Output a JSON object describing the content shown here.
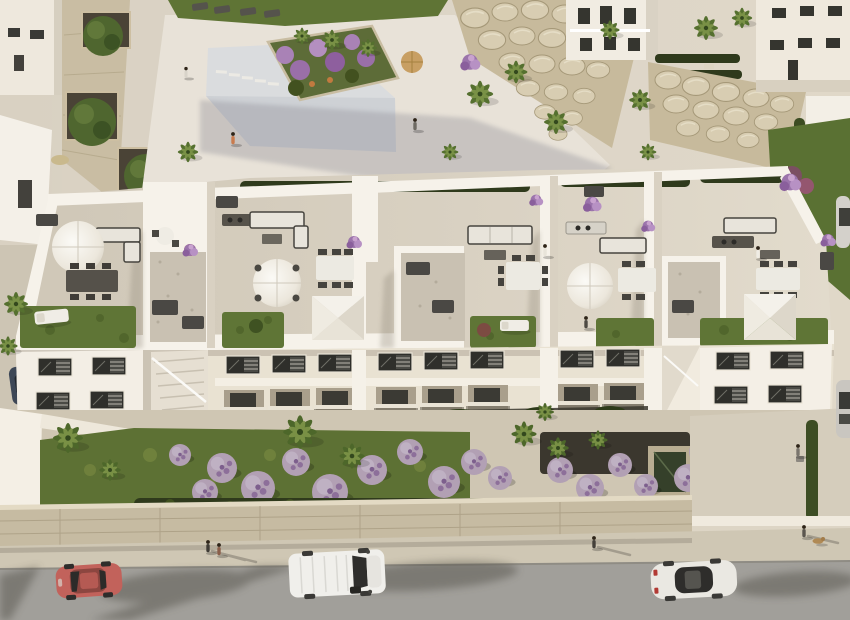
{
  "meta": {
    "type": "aerial-architectural-render",
    "description": "Bird's-eye 3D rendering of a white modern apartment block with private rooftop terraces (parasols, shade canopies, outdoor sofas, dining sets, green-roof lawns), a communal pool deck with rock garden and palm trees behind it, lush lavender-bush front gardens, and a street with parked cars in front.",
    "width": 850,
    "height": 620
  },
  "palette": {
    "paving": "#d9d1c2",
    "deck": "#e8e2d8",
    "pool": "#dadcde",
    "poolShade": "#c5c8ce",
    "lawn": "#5d7134",
    "lawnTop": "#5f7435",
    "grassRoof": "#5f7536",
    "rock": "#c7ba9c",
    "white": "#f6f2ea",
    "whiteBright": "#f4efe5",
    "roofFloor": "#d8d0c1",
    "gravel": "#c9c1b2",
    "facade": "#e9e2d2",
    "mulch": "#3b372e",
    "hedge": "#2f3a1c",
    "bush": "#b2a0b4",
    "palm": "#55702f",
    "road": "#a19f9a",
    "sidewalk": "#cfc7b4",
    "stoneWall": "#c6bba2",
    "driveway": "#d5cdbc",
    "carRed": "#c2625b",
    "vanWhite": "#f0efeb",
    "sedanWhite": "#eae8e2",
    "carBlue": "#3d4756",
    "shadow": "#3f3c36",
    "purple": "#9b74ab",
    "window": "#2f2f2b",
    "cushion": "#e8e4db",
    "furnitureDark": "#47453f"
  },
  "inventory": {
    "vehicles": [
      {
        "kind": "red hatchback",
        "color": "#c2625b"
      },
      {
        "kind": "white delivery van",
        "color": "#f0efeb"
      },
      {
        "kind": "white sedan",
        "color": "#eae8e2"
      },
      {
        "kind": "dark car parked left lane",
        "color": "#3d4756"
      },
      {
        "kind": "gray car right edge (partial)",
        "color": "#c9c6c0"
      }
    ],
    "rooftop_amenities": [
      "round parasols",
      "square shade canopies",
      "outdoor sofas",
      "dining tables with chairs",
      "sun loungers",
      "outdoor kitchens with grills",
      "artificial-grass green roofs",
      "flower planters"
    ],
    "grounds": [
      "swimming pool deck",
      "raised flower planter",
      "boulder rock walls",
      "hedge rows",
      "palm trees",
      "lavender bushes",
      "front hedge",
      "stone retaining wall",
      "sidewalk",
      "asphalt road"
    ],
    "people_visible": 11
  },
  "scene": {
    "instances": [
      {
        "symbol": "palm",
        "layer": "layer-palms-top",
        "color": "#55702f",
        "items": [
          [
            188,
            152,
            0.85
          ],
          [
            480,
            94,
            1.1
          ],
          [
            516,
            72,
            0.95
          ],
          [
            556,
            122,
            1.0
          ],
          [
            610,
            30,
            0.8
          ],
          [
            640,
            100,
            0.9
          ],
          [
            706,
            28,
            1.0
          ],
          [
            742,
            18,
            0.85
          ],
          [
            648,
            152,
            0.7
          ],
          [
            302,
            36,
            0.7
          ],
          [
            332,
            40,
            0.85
          ],
          [
            368,
            48,
            0.75
          ],
          [
            16,
            304,
            1.0
          ],
          [
            8,
            346,
            0.8
          ],
          [
            450,
            152,
            0.7
          ]
        ]
      },
      {
        "symbol": "palm",
        "layer": "layer-palms-garden",
        "color": "#4d672a",
        "items": [
          [
            68,
            438,
            1.25
          ],
          [
            110,
            470,
            0.9
          ],
          [
            300,
            432,
            1.4
          ],
          [
            352,
            456,
            1.05
          ],
          [
            524,
            434,
            1.05
          ],
          [
            558,
            448,
            0.9
          ],
          [
            598,
            440,
            0.8
          ],
          [
            545,
            412,
            0.75
          ]
        ]
      },
      {
        "symbol": "boulder",
        "layer": "layer-boulders-1",
        "items": [
          [
            475,
            18,
            1.1
          ],
          [
            505,
            12,
            1.0
          ],
          [
            535,
            10,
            1.05
          ],
          [
            565,
            14,
            1.0
          ],
          [
            595,
            12,
            1.05
          ],
          [
            622,
            18,
            0.95
          ],
          [
            492,
            40,
            1.05
          ],
          [
            522,
            36,
            1.0
          ],
          [
            552,
            38,
            1.05
          ],
          [
            582,
            40,
            1.0
          ],
          [
            610,
            44,
            0.9
          ],
          [
            512,
            62,
            1.0
          ],
          [
            542,
            64,
            1.0
          ],
          [
            572,
            66,
            1.0
          ],
          [
            598,
            70,
            0.9
          ],
          [
            528,
            88,
            0.9
          ],
          [
            556,
            92,
            0.9
          ],
          [
            584,
            96,
            0.85
          ],
          [
            545,
            112,
            0.8
          ],
          [
            572,
            118,
            0.8
          ],
          [
            558,
            134,
            0.7
          ]
        ]
      },
      {
        "symbol": "boulder",
        "layer": "layer-boulders-2",
        "items": [
          [
            668,
            80,
            1.0
          ],
          [
            696,
            86,
            1.05
          ],
          [
            726,
            92,
            1.05
          ],
          [
            756,
            98,
            1.0
          ],
          [
            782,
            104,
            0.9
          ],
          [
            676,
            104,
            1.0
          ],
          [
            706,
            110,
            1.0
          ],
          [
            736,
            116,
            1.0
          ],
          [
            766,
            122,
            0.9
          ],
          [
            688,
            128,
            0.9
          ],
          [
            718,
            134,
            0.9
          ],
          [
            748,
            140,
            0.85
          ]
        ]
      },
      {
        "symbol": "win",
        "layer": "layer-windows",
        "items": [
          [
            38,
            358
          ],
          [
            92,
            357
          ],
          [
            226,
            356
          ],
          [
            272,
            355
          ],
          [
            318,
            354
          ],
          [
            378,
            353
          ],
          [
            424,
            352
          ],
          [
            470,
            351
          ],
          [
            560,
            350
          ],
          [
            606,
            349
          ],
          [
            716,
            352
          ],
          [
            770,
            351
          ],
          [
            36,
            392
          ],
          [
            90,
            391
          ],
          [
            714,
            386
          ],
          [
            768,
            385
          ]
        ]
      },
      {
        "symbol": "recess",
        "layer": "layer-recesses",
        "items": [
          [
            224,
            390
          ],
          [
            270,
            389
          ],
          [
            316,
            388
          ],
          [
            376,
            387
          ],
          [
            422,
            386
          ],
          [
            468,
            385
          ],
          [
            558,
            384
          ],
          [
            604,
            383
          ]
        ]
      },
      {
        "symbol": "bush",
        "layer": "layer-bushes",
        "color": "#b2a0b4",
        "items": [
          [
            222,
            468,
            1.5
          ],
          [
            258,
            488,
            1.7
          ],
          [
            296,
            462,
            1.4
          ],
          [
            330,
            492,
            1.8
          ],
          [
            372,
            470,
            1.5
          ],
          [
            410,
            452,
            1.3
          ],
          [
            444,
            482,
            1.6
          ],
          [
            474,
            462,
            1.3
          ],
          [
            500,
            478,
            1.2
          ],
          [
            560,
            470,
            1.3
          ],
          [
            590,
            488,
            1.4
          ],
          [
            620,
            465,
            1.2
          ],
          [
            688,
            478,
            1.4
          ],
          [
            716,
            498,
            1.5
          ],
          [
            744,
            472,
            1.3
          ],
          [
            772,
            494,
            1.4
          ],
          [
            700,
            452,
            1.1
          ],
          [
            180,
            455,
            1.1
          ],
          [
            205,
            492,
            1.3
          ],
          [
            646,
            486,
            1.2
          ]
        ]
      },
      {
        "symbol": "pflower",
        "layer": "layer-roof-flowers",
        "items": [
          [
            190,
            250,
            1
          ],
          [
            354,
            242,
            1
          ],
          [
            592,
            204,
            1.2
          ],
          [
            828,
            240,
            1
          ],
          [
            648,
            226,
            0.9
          ],
          [
            536,
            200,
            0.9
          ],
          [
            470,
            62,
            1.3
          ],
          [
            790,
            182,
            1.4
          ]
        ]
      },
      {
        "symbol": "person",
        "layer": "layer-people",
        "items": [
          [
            233,
            140,
            1,
            "#c97b4e"
          ],
          [
            415,
            126,
            1,
            "#6e6a63"
          ],
          [
            186,
            74,
            0.9,
            "#d8d3c9"
          ],
          [
            545,
            252,
            1,
            "#e8e4da"
          ],
          [
            586,
            324,
            1,
            "#4e4a44"
          ],
          [
            758,
            254,
            1,
            "#efece4"
          ],
          [
            208,
            548,
            1,
            "#3f3b35"
          ],
          [
            219,
            551,
            1,
            "#8a5f4a"
          ],
          [
            594,
            544,
            1,
            "#44403a"
          ],
          [
            798,
            452,
            1,
            "#7a756d"
          ],
          [
            804,
            533,
            1,
            "#5b564f"
          ]
        ]
      }
    ]
  }
}
